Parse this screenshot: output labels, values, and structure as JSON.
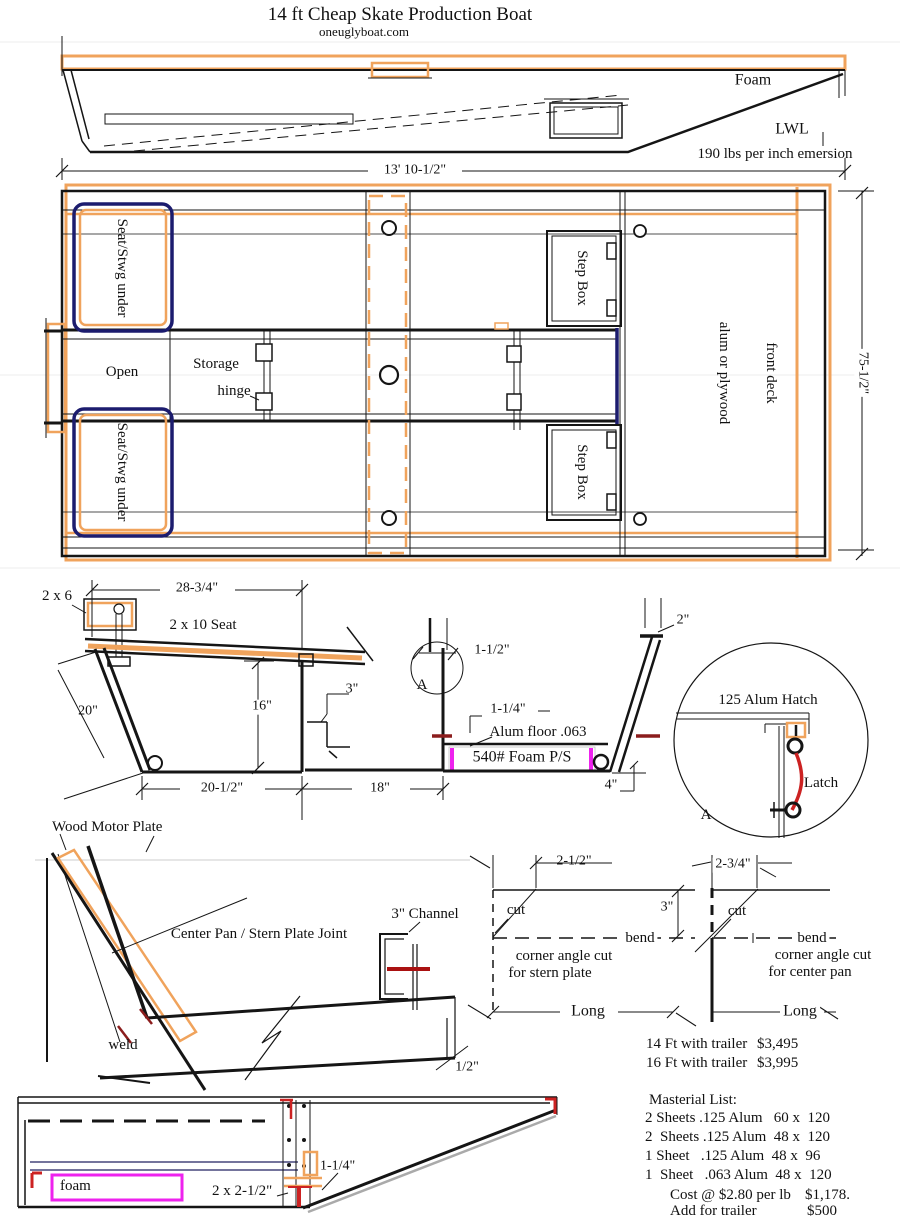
{
  "title": "14 ft Cheap Skate Production Boat",
  "subtitle": "oneuglyboat.com",
  "colors": {
    "orange": "#f0a35c",
    "navy": "#1c1c6e",
    "magenta": "#ee22ee",
    "red": "#cc2222",
    "weld_red": "#8b1d1d"
  },
  "side_view": {
    "foam_label": "Foam",
    "waterline_label": "LWL",
    "displacement_note": "190 lbs per inch emersion",
    "length_dim": "13' 10-1/2\""
  },
  "plan_view": {
    "seat_fwd_label": "Seat/Stwg under",
    "seat_aft_label": "Seat/Stwg under",
    "open_label": "Open",
    "storage_label": "Storage",
    "hinge_label": "hinge",
    "step_box_fwd": "Step Box",
    "step_box_aft": "Step Box",
    "front_deck_line1": "front deck",
    "front_deck_line2": "alum or plywood",
    "beam_dim": "75-1/2\""
  },
  "section_view": {
    "gunwale_lumber": "2 x 6",
    "seat_width_dim": "28-3/4\"",
    "seat_label": "2 x 10 Seat",
    "side_dim": "20\"",
    "depth_dim": "16\"",
    "ledge_dim": "3\"",
    "floor_width_dim": "20-1/2\"",
    "keel_width_dim": "18\"",
    "flange_dim": "1-1/2\"",
    "detail_ref": "A",
    "lip_dim": "1-1/4\"",
    "floor_label": "Alum floor .063",
    "foam_label": "540# Foam P/S",
    "foam_dim": "4\"",
    "top_dim": "2\""
  },
  "hatch_detail": {
    "title": "125 Alum Hatch",
    "latch_label": "Latch",
    "ref": "A"
  },
  "joint_view": {
    "motor_plate_label": "Wood Motor Plate",
    "title": "Center Pan / Stern Plate Joint",
    "channel_label": "3\" Channel",
    "weld_label": "weld",
    "thickness_dim": "1/2\""
  },
  "stern_plate_cut": {
    "offset_dim": "2-1/2\"",
    "cut_label": "cut",
    "height_dim": "3\"",
    "bend_label": "bend",
    "caption_line1": "corner angle cut",
    "caption_line2": "for stern plate",
    "length_label": "Long"
  },
  "center_pan_cut": {
    "offset_dim": "2-3/4\"",
    "cut_label": "cut",
    "bend_label": "bend",
    "caption_line1": "corner angle cut",
    "caption_line2": "for center pan",
    "length_label": "Long"
  },
  "pricing": [
    {
      "label": "14 Ft with trailer",
      "price": "$3,495"
    },
    {
      "label": "16 Ft with trailer",
      "price": "$3,995"
    }
  ],
  "materials": {
    "heading": "Masterial List:",
    "items": [
      "2 Sheets .125 Alum   60 x  120",
      "2  Sheets .125 Alum  48 x  120",
      "1 Sheet   .125 Alum  48 x  96",
      "1  Sheet   .063 Alum  48 x  120"
    ],
    "cost_label": "Cost @ $2.80 per lb",
    "cost_value": "$1,178.",
    "trailer_label": "Add for trailer",
    "trailer_value": "$500"
  },
  "stern_detail": {
    "foam_label": "foam",
    "lumber_label": "2 x 2-1/2\"",
    "lip_dim": "1-1/4\""
  }
}
